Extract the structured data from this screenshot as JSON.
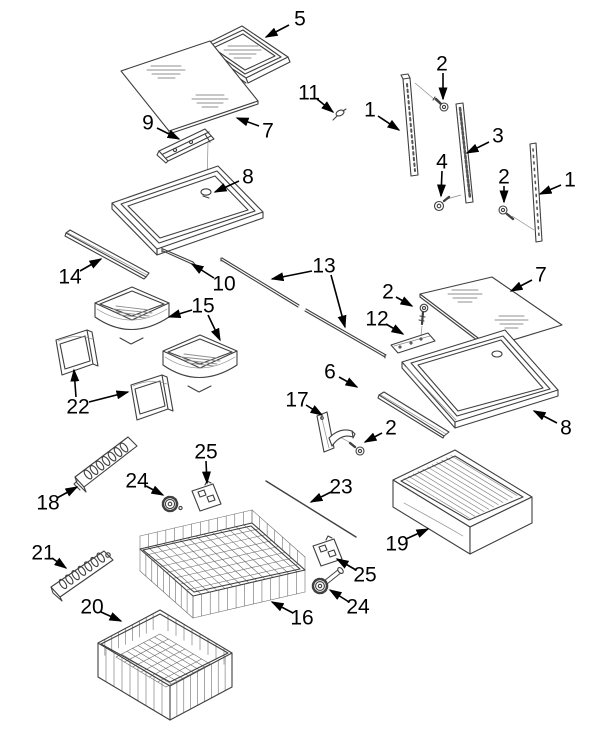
{
  "figure": {
    "kind": "exploded-parts-diagram",
    "colors": {
      "background": "#ffffff",
      "line": "#3f3f3f",
      "hatch": "#8f8f8f",
      "label": "#000000"
    }
  },
  "callouts": [
    {
      "part": "5",
      "x": 300,
      "y": 19,
      "arrows": [
        {
          "x1": 289,
          "y1": 25,
          "x2": 266,
          "y2": 37
        }
      ]
    },
    {
      "part": "7",
      "x": 268,
      "y": 131,
      "arrows": [
        {
          "x1": 259,
          "y1": 126,
          "x2": 237,
          "y2": 118
        }
      ]
    },
    {
      "part": "9",
      "x": 148,
      "y": 123,
      "arrows": [
        {
          "x1": 157,
          "y1": 128,
          "x2": 179,
          "y2": 139
        }
      ]
    },
    {
      "part": "8",
      "x": 248,
      "y": 177,
      "arrows": [
        {
          "x1": 239,
          "y1": 181,
          "x2": 215,
          "y2": 192
        }
      ]
    },
    {
      "part": "11",
      "x": 309,
      "y": 93,
      "arrows": [
        {
          "x1": 317,
          "y1": 99,
          "x2": 333,
          "y2": 112
        }
      ]
    },
    {
      "part": "1",
      "x": 370,
      "y": 110,
      "arrows": [
        {
          "x1": 378,
          "y1": 116,
          "x2": 399,
          "y2": 130
        }
      ]
    },
    {
      "part": "2",
      "x": 442,
      "y": 64,
      "arrows": [
        {
          "x1": 443,
          "y1": 73,
          "x2": 443,
          "y2": 99
        }
      ]
    },
    {
      "part": "3",
      "x": 498,
      "y": 136,
      "arrows": [
        {
          "x1": 489,
          "y1": 142,
          "x2": 467,
          "y2": 153
        }
      ]
    },
    {
      "part": "4",
      "x": 442,
      "y": 162,
      "arrows": [
        {
          "x1": 442,
          "y1": 171,
          "x2": 441,
          "y2": 196
        }
      ]
    },
    {
      "part": "2",
      "x": 504,
      "y": 177,
      "arrows": [
        {
          "x1": 504,
          "y1": 186,
          "x2": 504,
          "y2": 202
        }
      ]
    },
    {
      "part": "1",
      "x": 570,
      "y": 180,
      "arrows": [
        {
          "x1": 561,
          "y1": 185,
          "x2": 540,
          "y2": 194
        }
      ]
    },
    {
      "part": "14",
      "x": 70,
      "y": 277,
      "arrows": [
        {
          "x1": 80,
          "y1": 271,
          "x2": 101,
          "y2": 259
        }
      ]
    },
    {
      "part": "10",
      "x": 224,
      "y": 284,
      "arrows": [
        {
          "x1": 214,
          "y1": 278,
          "x2": 192,
          "y2": 264
        }
      ]
    },
    {
      "part": "13",
      "x": 324,
      "y": 266,
      "arrows": [
        {
          "x1": 312,
          "y1": 271,
          "x2": 272,
          "y2": 279
        },
        {
          "x1": 331,
          "y1": 275,
          "x2": 345,
          "y2": 327
        }
      ]
    },
    {
      "part": "15",
      "x": 203,
      "y": 306,
      "arrows": [
        {
          "x1": 192,
          "y1": 310,
          "x2": 169,
          "y2": 317
        },
        {
          "x1": 208,
          "y1": 315,
          "x2": 220,
          "y2": 340
        }
      ]
    },
    {
      "part": "22",
      "x": 78,
      "y": 407,
      "arrows": [
        {
          "x1": 76,
          "y1": 397,
          "x2": 74,
          "y2": 370
        },
        {
          "x1": 89,
          "y1": 402,
          "x2": 128,
          "y2": 392
        }
      ]
    },
    {
      "part": "2",
      "x": 388,
      "y": 292,
      "arrows": [
        {
          "x1": 396,
          "y1": 297,
          "x2": 412,
          "y2": 306
        }
      ]
    },
    {
      "part": "12",
      "x": 377,
      "y": 319,
      "arrows": [
        {
          "x1": 386,
          "y1": 324,
          "x2": 403,
          "y2": 334
        }
      ]
    },
    {
      "part": "7",
      "x": 541,
      "y": 275,
      "arrows": [
        {
          "x1": 532,
          "y1": 280,
          "x2": 511,
          "y2": 291
        }
      ]
    },
    {
      "part": "6",
      "x": 330,
      "y": 372,
      "arrows": [
        {
          "x1": 339,
          "y1": 377,
          "x2": 357,
          "y2": 387
        }
      ]
    },
    {
      "part": "8",
      "x": 566,
      "y": 428,
      "arrows": [
        {
          "x1": 557,
          "y1": 423,
          "x2": 534,
          "y2": 411
        }
      ]
    },
    {
      "part": "17",
      "x": 297,
      "y": 400,
      "arrows": [
        {
          "x1": 306,
          "y1": 405,
          "x2": 322,
          "y2": 415
        }
      ]
    },
    {
      "part": "2",
      "x": 391,
      "y": 428,
      "arrows": [
        {
          "x1": 382,
          "y1": 433,
          "x2": 365,
          "y2": 442
        }
      ]
    },
    {
      "part": "18",
      "x": 48,
      "y": 503,
      "arrows": [
        {
          "x1": 57,
          "y1": 498,
          "x2": 77,
          "y2": 487
        }
      ]
    },
    {
      "part": "24",
      "x": 137,
      "y": 481,
      "arrows": [
        {
          "x1": 146,
          "y1": 486,
          "x2": 163,
          "y2": 495
        }
      ]
    },
    {
      "part": "25",
      "x": 206,
      "y": 452,
      "arrows": [
        {
          "x1": 206,
          "y1": 461,
          "x2": 207,
          "y2": 483
        }
      ]
    },
    {
      "part": "23",
      "x": 341,
      "y": 487,
      "arrows": [
        {
          "x1": 331,
          "y1": 492,
          "x2": 311,
          "y2": 502
        }
      ]
    },
    {
      "part": "19",
      "x": 397,
      "y": 544,
      "arrows": [
        {
          "x1": 406,
          "y1": 539,
          "x2": 428,
          "y2": 529
        }
      ]
    },
    {
      "part": "25",
      "x": 365,
      "y": 575,
      "arrows": [
        {
          "x1": 356,
          "y1": 570,
          "x2": 337,
          "y2": 559
        }
      ]
    },
    {
      "part": "24",
      "x": 358,
      "y": 607,
      "arrows": [
        {
          "x1": 349,
          "y1": 602,
          "x2": 330,
          "y2": 590
        }
      ]
    },
    {
      "part": "16",
      "x": 302,
      "y": 618,
      "arrows": [
        {
          "x1": 293,
          "y1": 613,
          "x2": 272,
          "y2": 602
        }
      ]
    },
    {
      "part": "21",
      "x": 43,
      "y": 553,
      "arrows": [
        {
          "x1": 52,
          "y1": 558,
          "x2": 66,
          "y2": 568
        }
      ]
    },
    {
      "part": "20",
      "x": 92,
      "y": 607,
      "arrows": [
        {
          "x1": 101,
          "y1": 612,
          "x2": 121,
          "y2": 621
        }
      ]
    }
  ]
}
